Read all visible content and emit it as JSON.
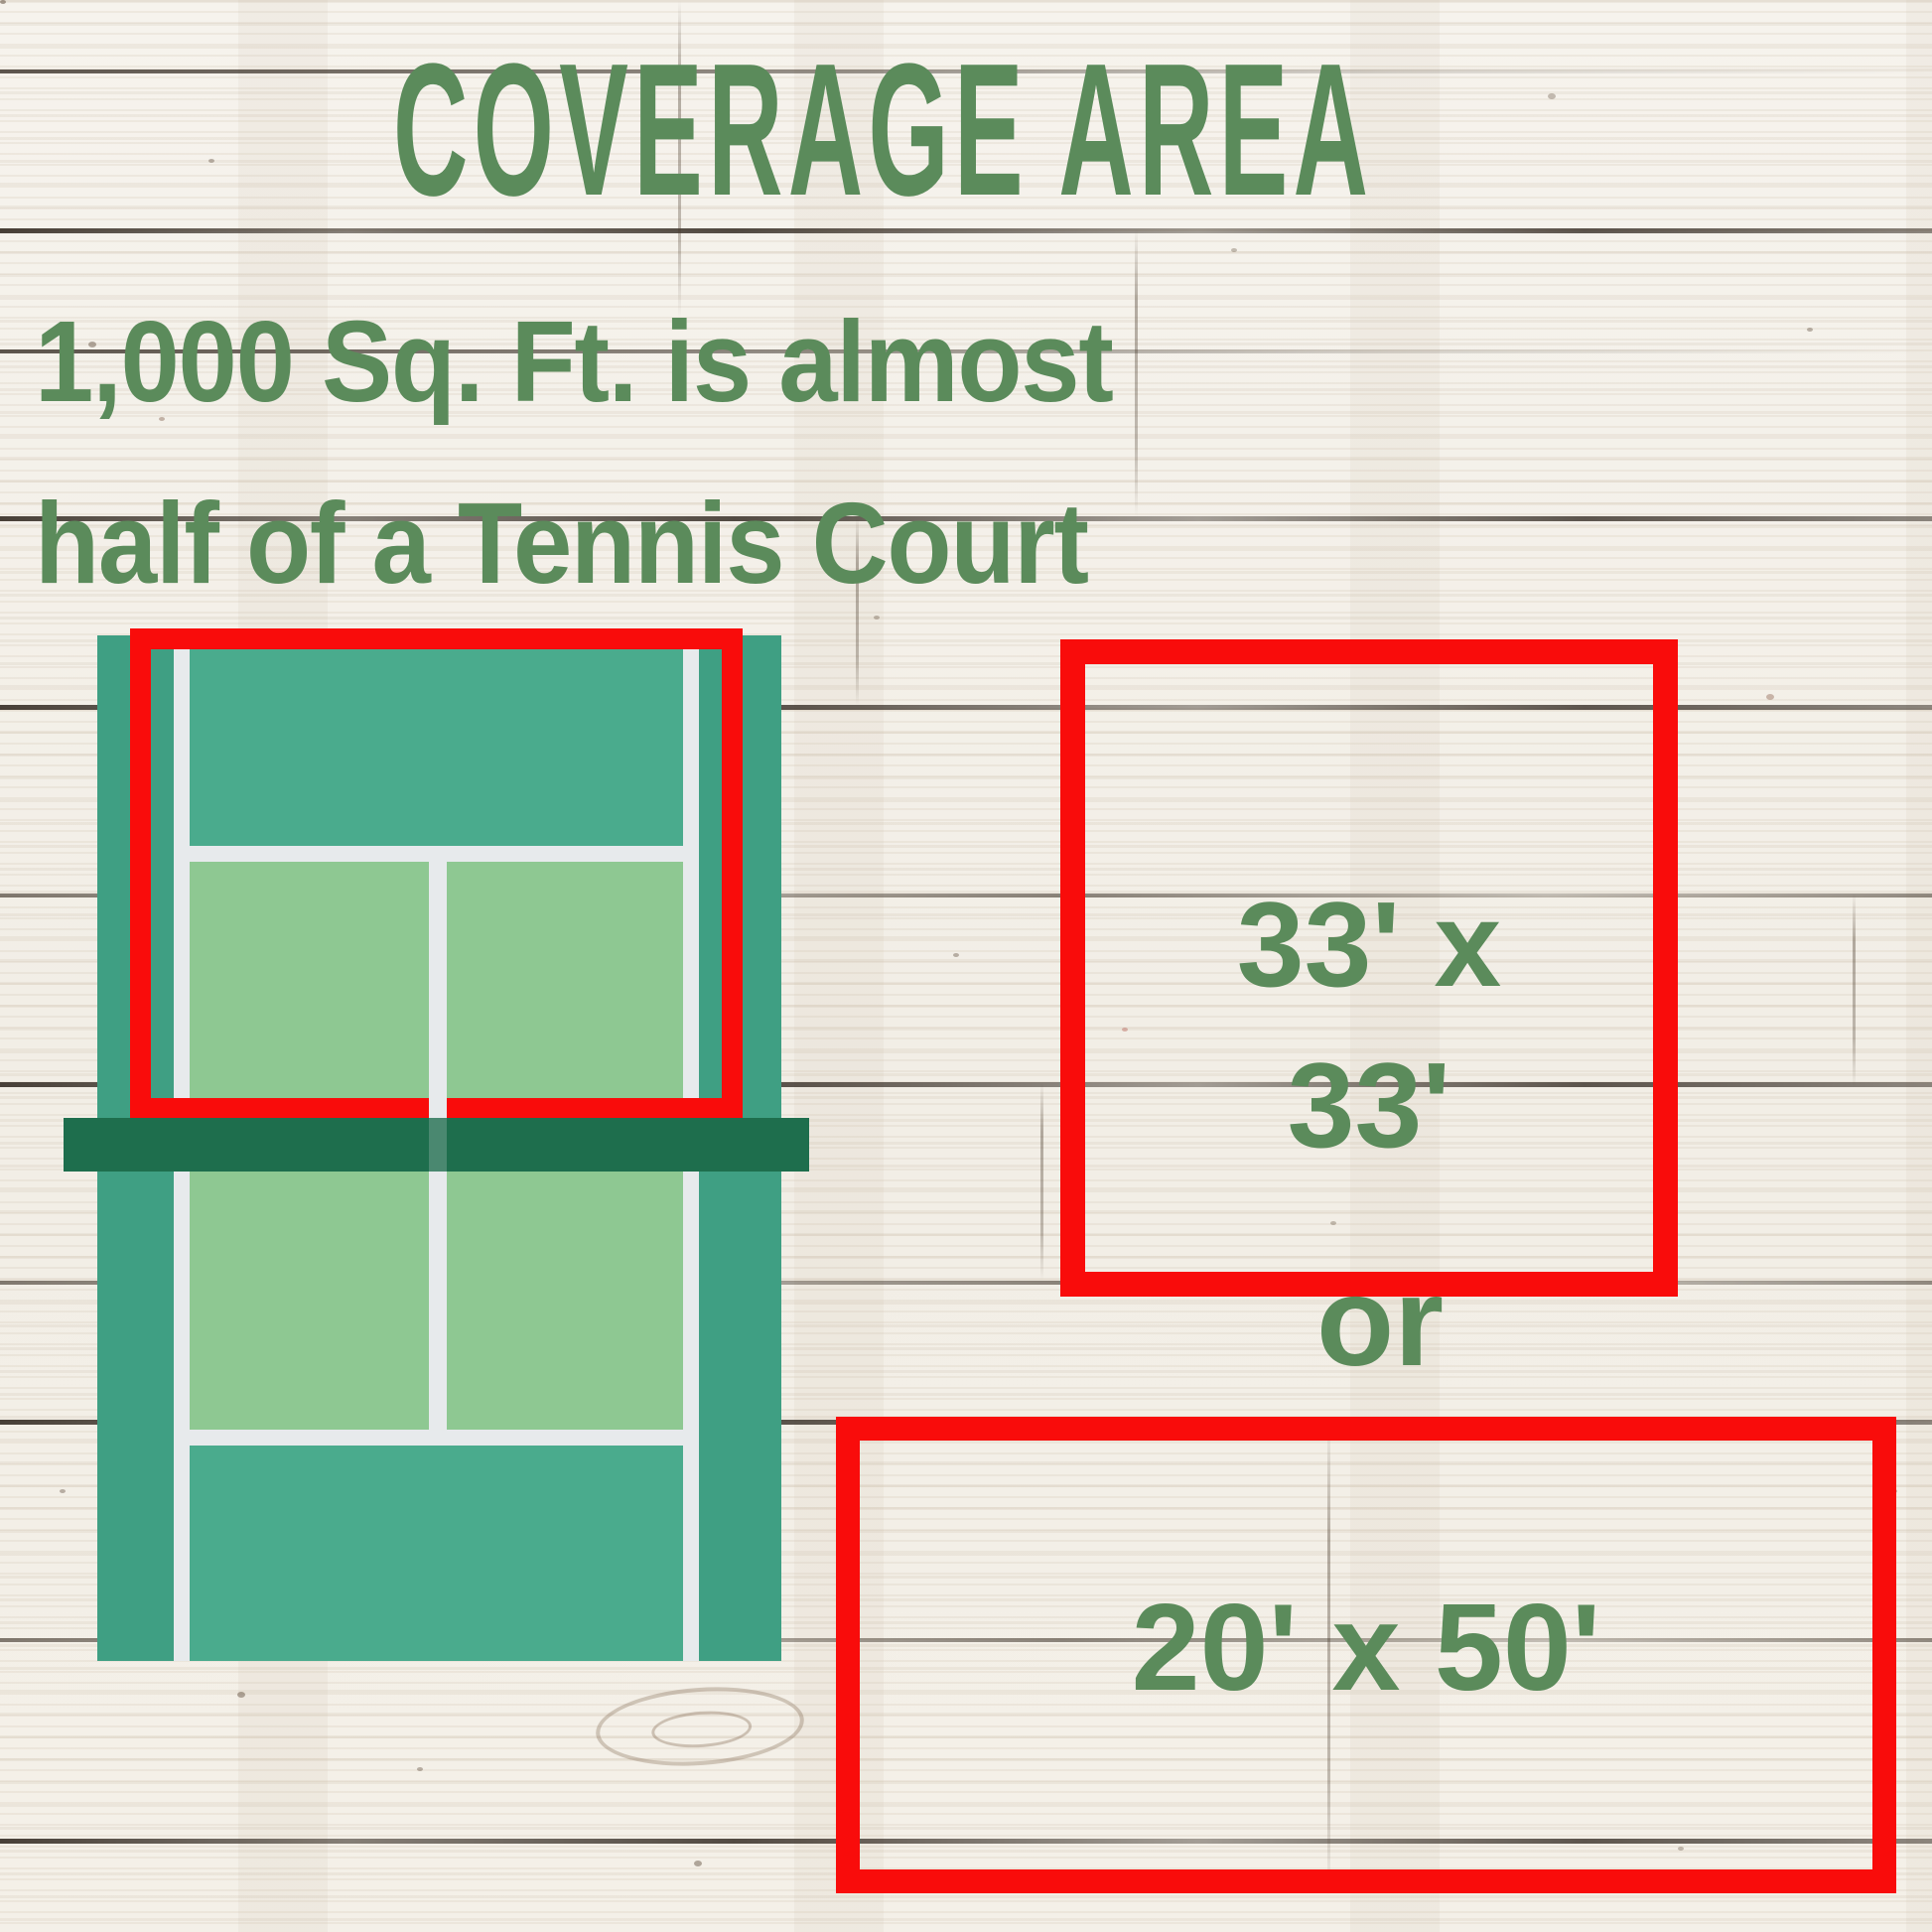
{
  "header": {
    "title": "COVERAGE AREA"
  },
  "description": {
    "line1": "1,000 Sq. Ft. is almost",
    "line2": "half of a Tennis Court"
  },
  "size_options": {
    "square": {
      "line1": "33' x",
      "line2": "33'"
    },
    "separator": "or",
    "rectangle": {
      "label": "20' x 50'"
    }
  },
  "colors": {
    "text_green": "#5b8b5b",
    "red": "#f90c0b",
    "court_surround": "#3f9f83",
    "court_backcourt": "#4aab8d",
    "court_box": "#8ec892",
    "court_net": "#1e6e4d",
    "court_line": "#e7eaec",
    "wood_base": "#f3efe8",
    "wood_seam": "#2a2119"
  }
}
